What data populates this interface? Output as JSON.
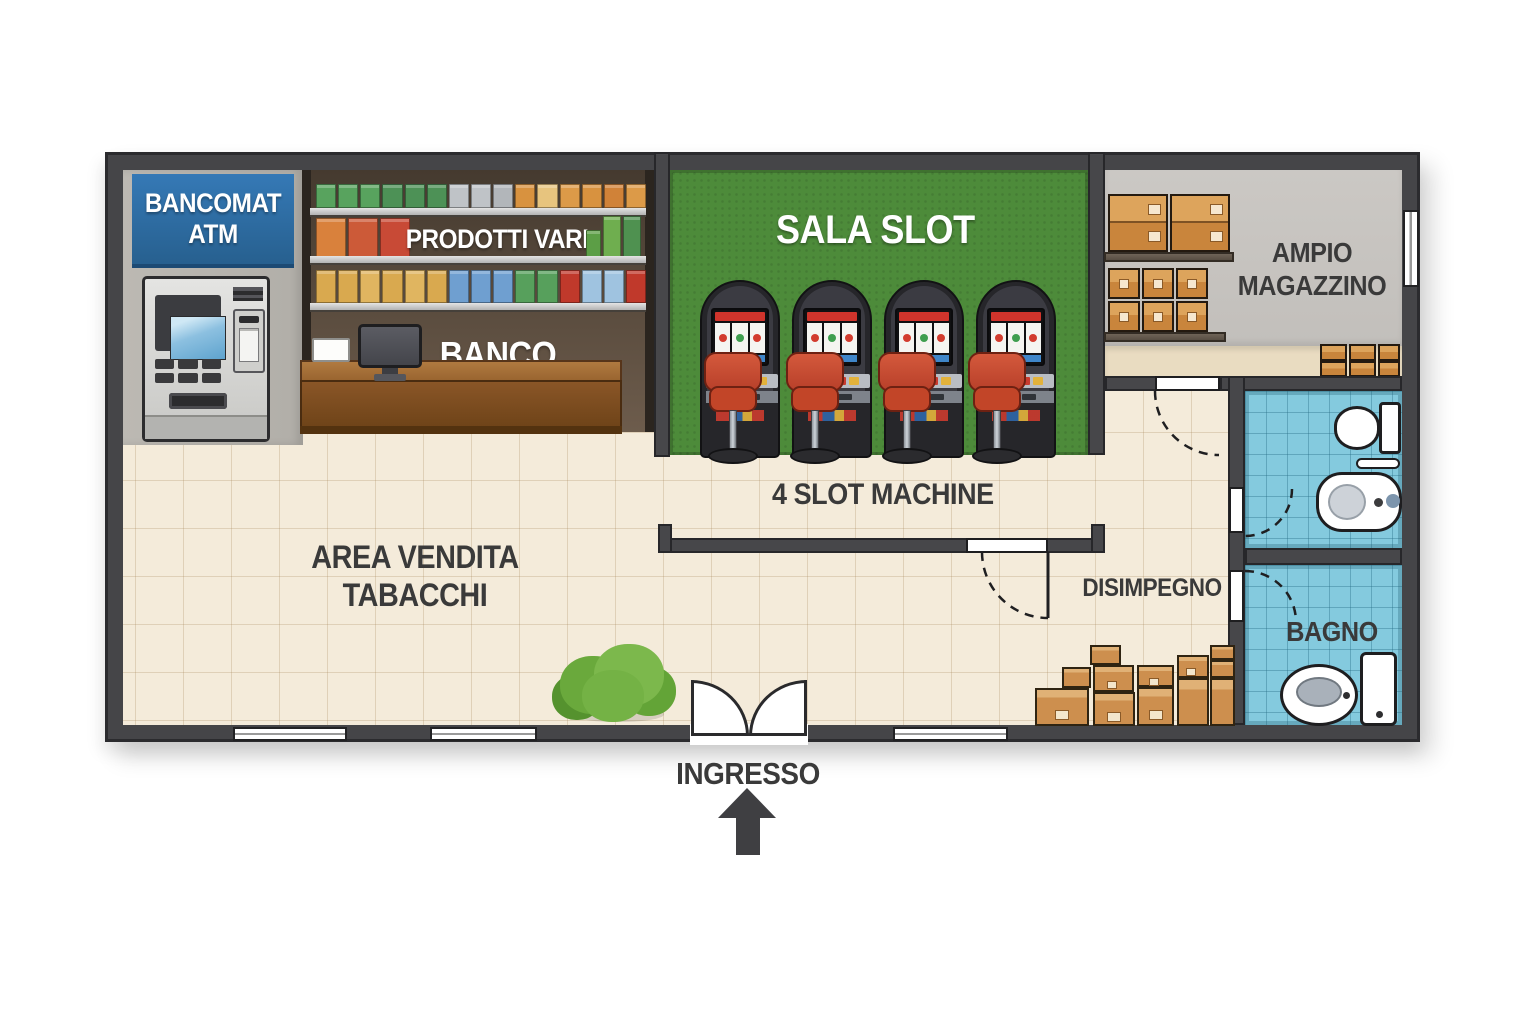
{
  "scene": {
    "type": "floor-plan",
    "subject": "Tabaccheria con sala slot",
    "language": "it"
  },
  "colors": {
    "wall": "#47474a",
    "floor": "#f4ebda",
    "slot_room_green": "#4d8b3a",
    "atm_sign_blue": "#2f74b0",
    "atm_wall_gray": "#b7b4ae",
    "shelf_background_brown": "#54463a",
    "counter_brown": "#8a5627",
    "storage_wall_gray": "#c8c5c1",
    "bathroom_tile_blue": "#84cade",
    "box_tan": "#d29044",
    "stool_red": "#c6452a",
    "machine_dark": "#26262a",
    "label_dark": "#3a3a3a",
    "label_white": "#ffffff"
  },
  "atm": {
    "sign_line1": "BANCOMAT",
    "sign_line2": "ATM"
  },
  "shop": {
    "shelf_label": "PRODOTTI VARI",
    "counter_label": "BANCO",
    "area_line1": "AREA VENDITA",
    "area_line2": "TABACCHI"
  },
  "slot_room": {
    "label": "SALA SLOT",
    "note": "4 SLOT MACHINE",
    "machine_count": 4
  },
  "storage": {
    "label_line1": "AMPIO",
    "label_line2": "MAGAZZINO"
  },
  "hallway": {
    "label": "DISIMPEGNO"
  },
  "bathroom": {
    "label": "BAGNO"
  },
  "entrance": {
    "label": "INGRESSO"
  },
  "shelf_products": {
    "row1": [
      "#58a35e",
      "#58a35e",
      "#58a35e",
      "#4d9156",
      "#4d9156",
      "#4d9156",
      "#bfc3c7",
      "#bfc3c7",
      "#b2b6ba",
      "#d8923f",
      "#e7c47e",
      "#dc9a48",
      "#d8923f",
      "#d08238",
      "#dc9a48"
    ],
    "row2_left": [
      "#d9813c",
      "#cc5a38",
      "#c84a36"
    ],
    "row2_right": [
      "#5c9e46",
      "#6fae4f",
      "#4f9150"
    ],
    "row3": [
      "#d9a94f",
      "#d9a94f",
      "#e0b560",
      "#d9a94f",
      "#e0b560",
      "#d9a94f",
      "#6f9fd0",
      "#6f9fd0",
      "#6f9fd0",
      "#57a05c",
      "#57a05c",
      "#c0392b",
      "#9fc3e0",
      "#9fc3e0",
      "#c0392b"
    ]
  },
  "slot_reel_colors": [
    "#d23c2e",
    "#3f9e4f",
    "#d23c2e"
  ]
}
